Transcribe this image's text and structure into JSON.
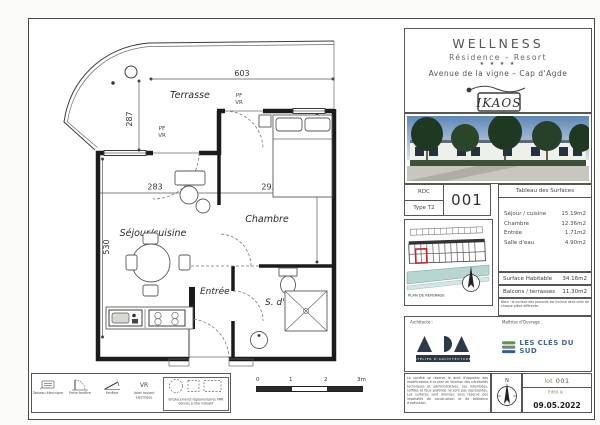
{
  "colors": {
    "highlight_red": "#c0272d",
    "water_teal": "#b7d6d2",
    "ada_navy": "#2c3947",
    "cles_blue": "#46648c",
    "cles_green": "#5f9648",
    "sky_blue": "#6f95bd",
    "tree_green": "#22381f",
    "line_ink": "#2a2a2a"
  },
  "plan": {
    "terrace_label": "Terrasse",
    "room_sejour": "Séjour/cuisine",
    "room_chambre": "Chambre",
    "room_entree": "Entrée",
    "room_sdeau": "S. d'eau",
    "pf_label": "PF",
    "vr_label": "VR",
    "dims": {
      "terrace_width": "603",
      "terrace_depth": "287",
      "sejour_width": "283",
      "chambre_width": "293",
      "chambre_depth": "440",
      "sejour_depth": "530"
    }
  },
  "legend": {
    "items": [
      {
        "label": "Tableau électrique"
      },
      {
        "label": "Porte fenêtre"
      },
      {
        "label": "Fenêtre"
      },
      {
        "label": "Volet roulant électrique"
      }
    ],
    "pmr_label": "Emplacements réglementaires PMR donnés à titre indicatif"
  },
  "scalebar": {
    "ticks": [
      "0",
      "1",
      "2",
      "3m"
    ]
  },
  "titleblock": {
    "project": {
      "name": "WELLNESS",
      "subtitle": "Résidence – Resort",
      "stars": "★ ★ ★ ★",
      "address": "Avenue de la vigne – Cap d'Agde",
      "logo_text": "IKAOS"
    },
    "unit": {
      "level": "RDC",
      "type": "Type T2",
      "number": "001"
    },
    "surfaces": {
      "title": "Tableau des Surfaces",
      "rows": [
        {
          "label": "Séjour / cuisine",
          "value": "15.19m2"
        },
        {
          "label": "Chambre",
          "value": "12.36m2"
        },
        {
          "label": "Entrée",
          "value": "1.71m2"
        },
        {
          "label": "Salle d'eau",
          "value": "4.90m2"
        }
      ],
      "habitable_label": "Surface Habitable",
      "habitable_value": "34.16m2",
      "balconies_label": "Balcons / terrasses",
      "balconies_value": "11.30m2",
      "note": "Nota : la surface des placards est incluse dans celle de chaque pièce afférente."
    },
    "reperage_label": "PLAN DE REPERAGE",
    "stakeholders": {
      "architect_label": "Architecte :",
      "architect_logo": "ADA",
      "architect_sub": "ATELIER D'ARCHITECTURE",
      "owner_label": "Maîtrise d'Ouvrage :",
      "owner_name": "LES CLÉS DU SUD"
    },
    "footer": {
      "disclaimer": "La société se réserve le droit d'apporter des modifications à ce plan en fonction des nécessités techniques et administratives. Les retombées, soffites et faux plafonds ne sont pas représentés. Les surfaces sont données sous réserve des impératifs de construction et de tolérance d'exécution.",
      "north_label": "N",
      "lot_label": "lot",
      "lot_number": "001",
      "edited_label": "Édité le :",
      "date": "09.05.2022"
    }
  }
}
